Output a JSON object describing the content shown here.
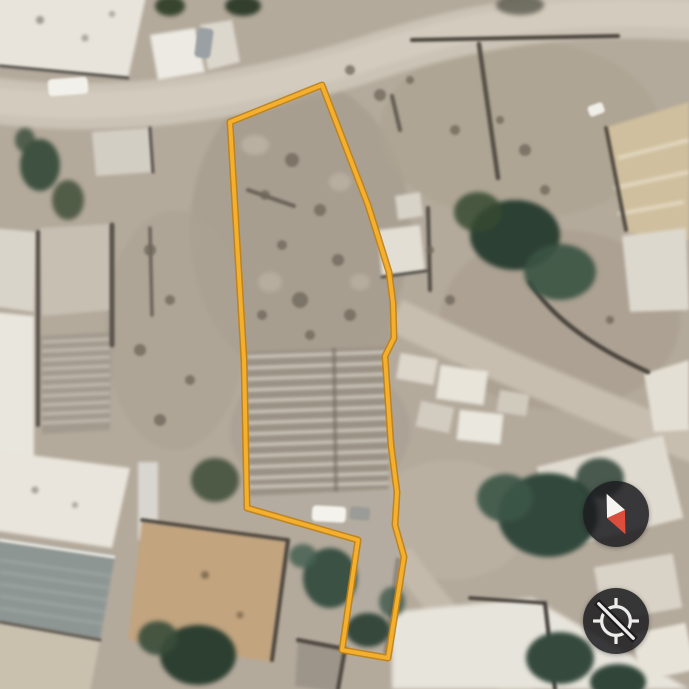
{
  "view": {
    "title": "Satellite map view",
    "imagery": "aerial"
  },
  "theme": {
    "accent": "#F4AF2C",
    "accent-casing": "#BE7F17",
    "control-bg": "rgba(28,28,31,0.86)",
    "control-bg-solid": "#1c1c1f",
    "needle-north": "#F7F5F1",
    "needle-south": "#DC4E3B",
    "glyph": "#EDECEA"
  },
  "parcel": {
    "outline_points": "322,85 368,205 389,272 393,303 394,338 385,356 391,445 397,492 395,525 404,557 388,658 342,650 358,540 247,508 244,360 230,122",
    "outline_color": "#F4AF2C",
    "outline_casing_color": "#BE7F17",
    "outline_width": "4"
  },
  "controls": {
    "compass_button": {
      "icon": "compass-icon",
      "needle_transform": "rotate(-25 22 28)"
    },
    "location_button": {
      "icon": "location-disabled-icon",
      "state": "disabled"
    }
  }
}
